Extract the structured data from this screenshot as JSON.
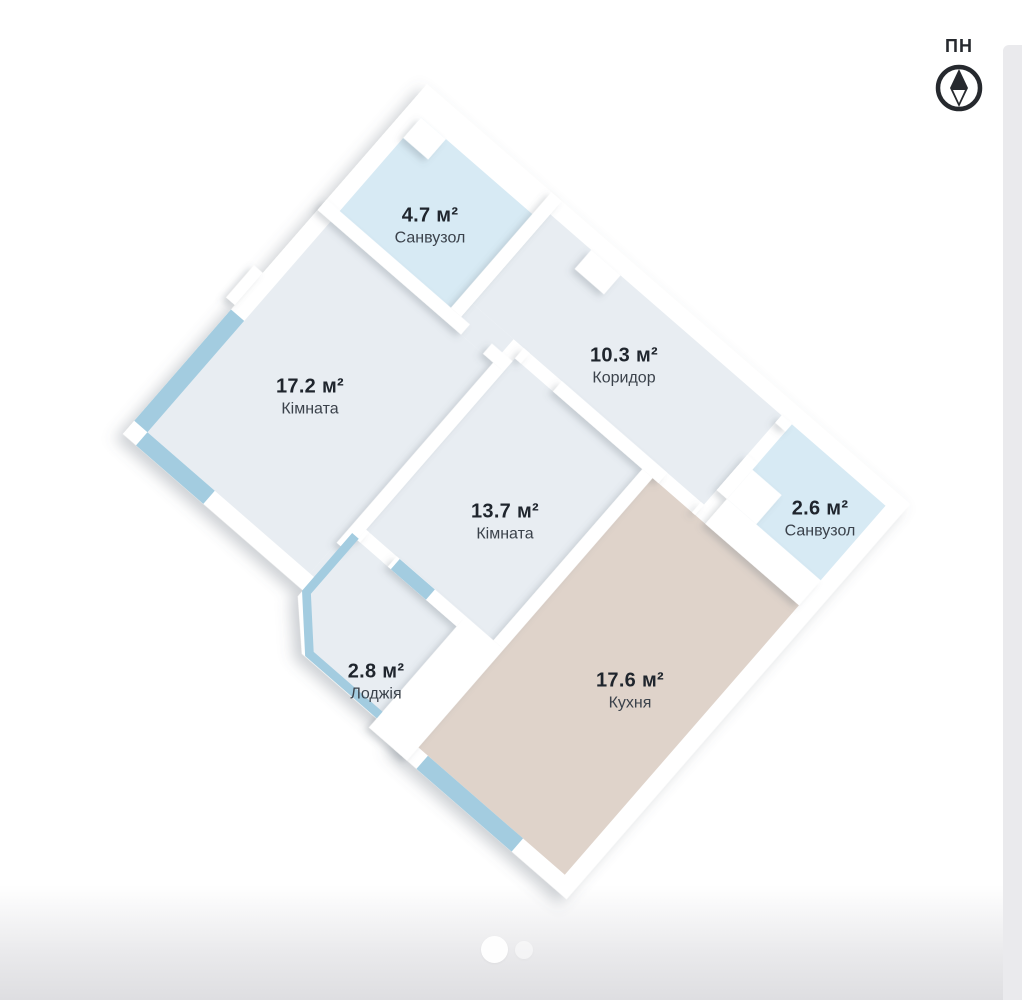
{
  "compass": {
    "label": "ПН"
  },
  "floor_plan": {
    "rotation_deg": 41,
    "rooms": [
      {
        "id": "sanvuzol-47",
        "name": "Санвузол",
        "area": "4.7 м²",
        "label_x": 430,
        "label_y": 226,
        "fill": "#d7eaf4"
      },
      {
        "id": "kimnata-172",
        "name": "Кімната",
        "area": "17.2 м²",
        "label_x": 310,
        "label_y": 397,
        "fill": "#e8edf2"
      },
      {
        "id": "korydor-103",
        "name": "Коридор",
        "area": "10.3 м²",
        "label_x": 624,
        "label_y": 366,
        "fill": "#e8edf2"
      },
      {
        "id": "kimnata-137",
        "name": "Кімната",
        "area": "13.7 м²",
        "label_x": 505,
        "label_y": 522,
        "fill": "#e8edf2"
      },
      {
        "id": "sanvuzol-26",
        "name": "Санвузол",
        "area": "2.6 м²",
        "label_x": 820,
        "label_y": 519,
        "fill": "#d7eaf4"
      },
      {
        "id": "kukhnia-176",
        "name": "Кухня",
        "area": "17.6 м²",
        "label_x": 630,
        "label_y": 691,
        "fill": "#dfd3ca"
      },
      {
        "id": "lodzhiia-28",
        "name": "Лоджія",
        "area": "2.8 м²",
        "label_x": 376,
        "label_y": 682,
        "fill": "#e8edf2"
      }
    ],
    "colors": {
      "wall": "#ffffff",
      "window_glazing": "#a3cce0",
      "room_gray": "#e8edf2",
      "bathroom_blue": "#d7eaf4",
      "kitchen_beige": "#dfd3ca",
      "label_value_text": "#1f252d",
      "label_name_text": "#3b424b",
      "compass_stroke": "#26292e"
    }
  },
  "carousel": {
    "dot_count": 2,
    "active_index": 0
  }
}
